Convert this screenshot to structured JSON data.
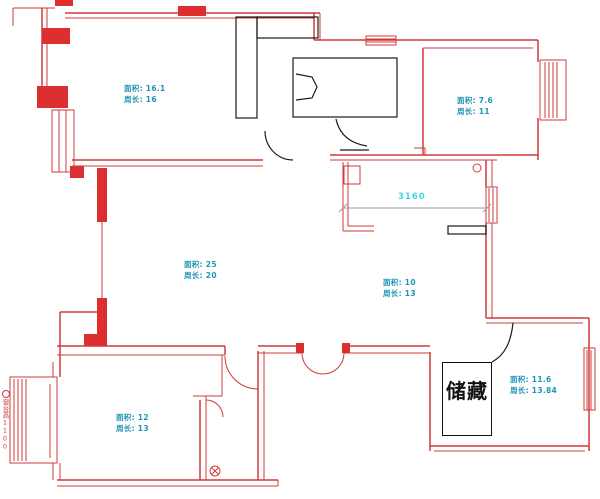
{
  "colors": {
    "wall": "#d13a3a",
    "wallfill": "#dd2f2f",
    "label": "#1d96b4",
    "dimension": "#3bd8e8",
    "furniture": "#1a1a1a",
    "dimline": "#9a9a9a",
    "bg": "#ffffff"
  },
  "rooms": [
    {
      "id": "bedroom-top-left",
      "area_label": "面积: 16.1",
      "perimeter_label": "周长: 16"
    },
    {
      "id": "room-top-right",
      "area_label": "面积: 7.6",
      "perimeter_label": "周长: 11"
    },
    {
      "id": "living-room",
      "area_label": "面积: 25",
      "perimeter_label": "周长: 20"
    },
    {
      "id": "room-mid-right",
      "area_label": "面积: 10",
      "perimeter_label": "周长: 13"
    },
    {
      "id": "room-bottom-left",
      "area_label": "面积: 12",
      "perimeter_label": "周长: 13"
    },
    {
      "id": "storage-room",
      "area_label": "面积: 11.6",
      "perimeter_label": "周长: 13.84"
    }
  ],
  "annotations": {
    "storage_text": "储藏",
    "dimension_value": "3160",
    "left_edge_note": "窗台高1100"
  }
}
